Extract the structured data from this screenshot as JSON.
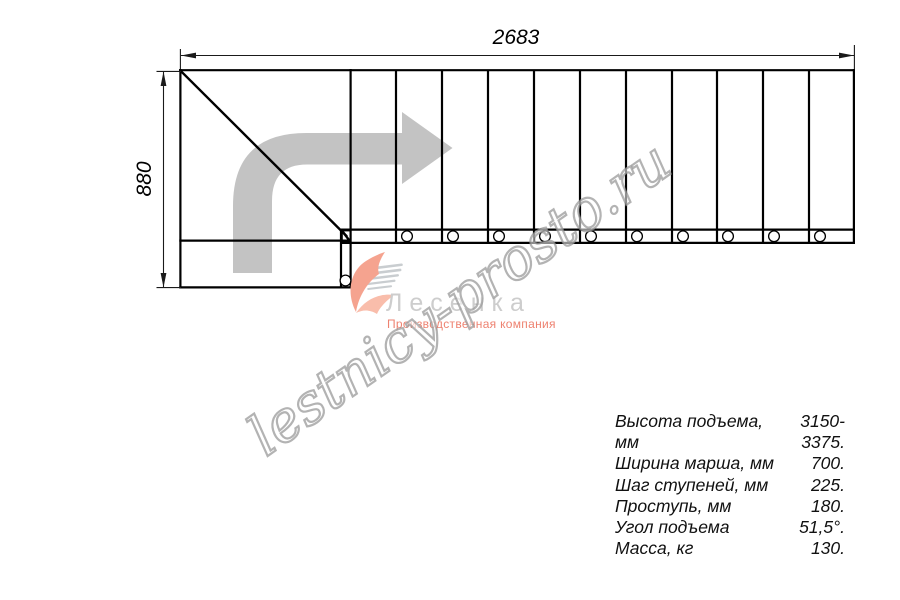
{
  "dimensions": {
    "width_mm": "2683",
    "height_mm": "880"
  },
  "specs": {
    "rows": [
      {
        "label": "Высота подъема, мм",
        "value": "3150-3375."
      },
      {
        "label": "Ширина марша, мм",
        "value": "700."
      },
      {
        "label": "Шаг ступеней, мм",
        "value": "225."
      },
      {
        "label": "Проступь, мм",
        "value": "180."
      },
      {
        "label": "Угол подъема",
        "value": "51,5°."
      },
      {
        "label": "Масса, кг",
        "value": "130."
      }
    ]
  },
  "watermark": {
    "text": "lestnicy-prosto.ru"
  },
  "logo": {
    "brand": "Лесенка",
    "subtitle": "Производственная компания"
  },
  "colors": {
    "arrow": "#c3c3c3",
    "line": "#000000",
    "swoosh": "#f5a38f",
    "swoosh_light": "#f9bdab",
    "speedline": "#c9cdd0",
    "subtitle_text": "#ee8270",
    "watermark_stroke": "#969696"
  }
}
